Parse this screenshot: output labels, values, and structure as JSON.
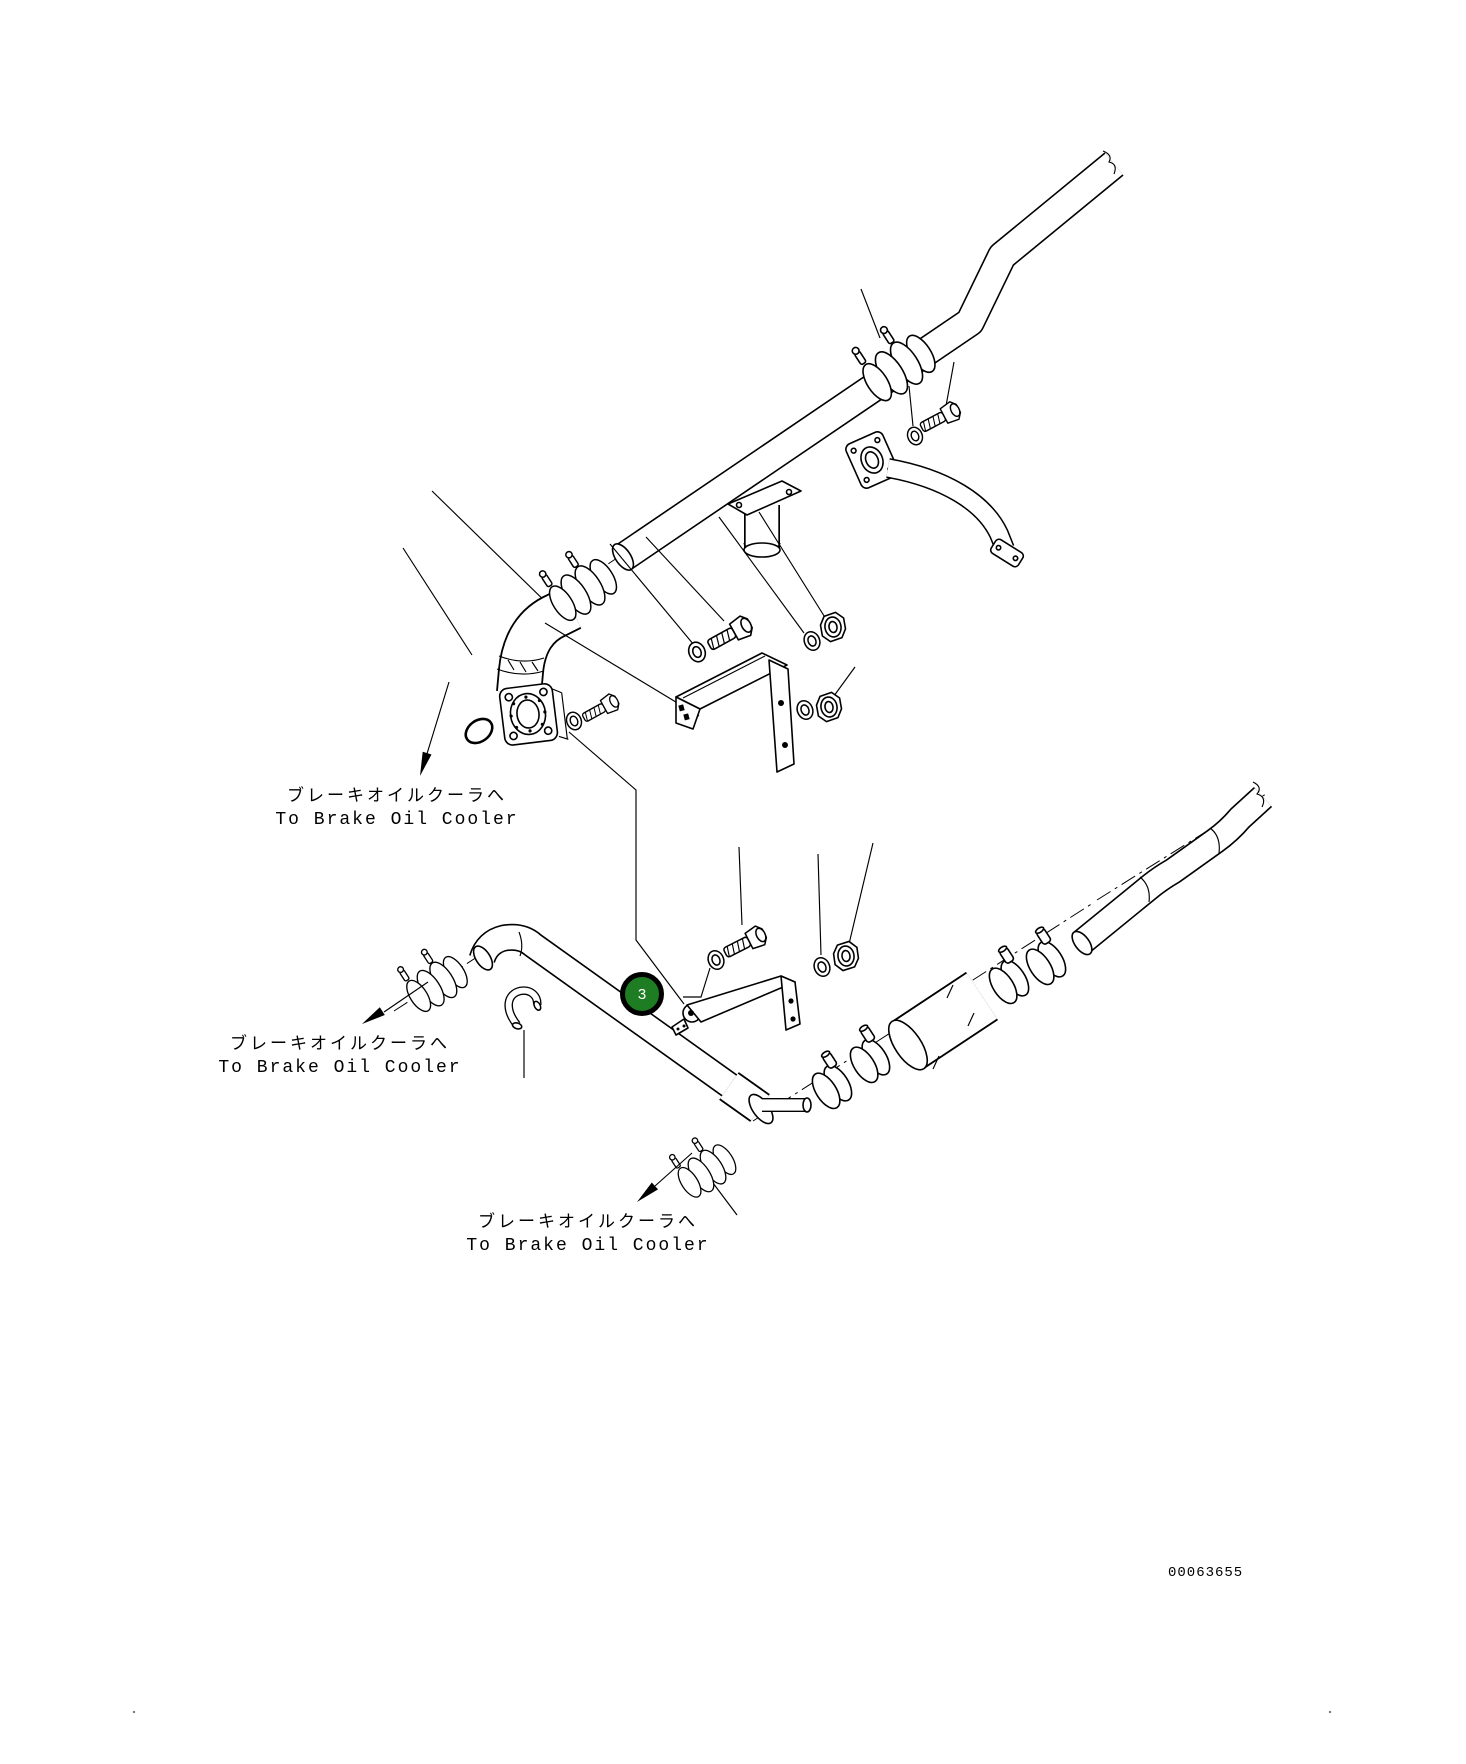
{
  "page": {
    "background": "#ffffff",
    "drawing_number": "00063655"
  },
  "labels": [
    {
      "id": "brake-oil-cooler-top",
      "jp": "ブレーキオイルクーラへ",
      "en": "To Brake Oil Cooler"
    },
    {
      "id": "brake-oil-cooler-middle",
      "jp": "ブレーキオイルクーラへ",
      "en": "To Brake Oil Cooler"
    },
    {
      "id": "brake-oil-cooler-bottom",
      "jp": "ブレーキオイルクーラへ",
      "en": "To Brake Oil Cooler"
    }
  ],
  "callouts": [
    {
      "number": "3",
      "fill_color": "#1e7d23",
      "ring_color": "#000000",
      "text_color": "#ffffff"
    }
  ],
  "drawing": {
    "type": "exploded-parts-line-drawing",
    "line_color": "#000000",
    "subject": "brake oil cooler piping"
  }
}
